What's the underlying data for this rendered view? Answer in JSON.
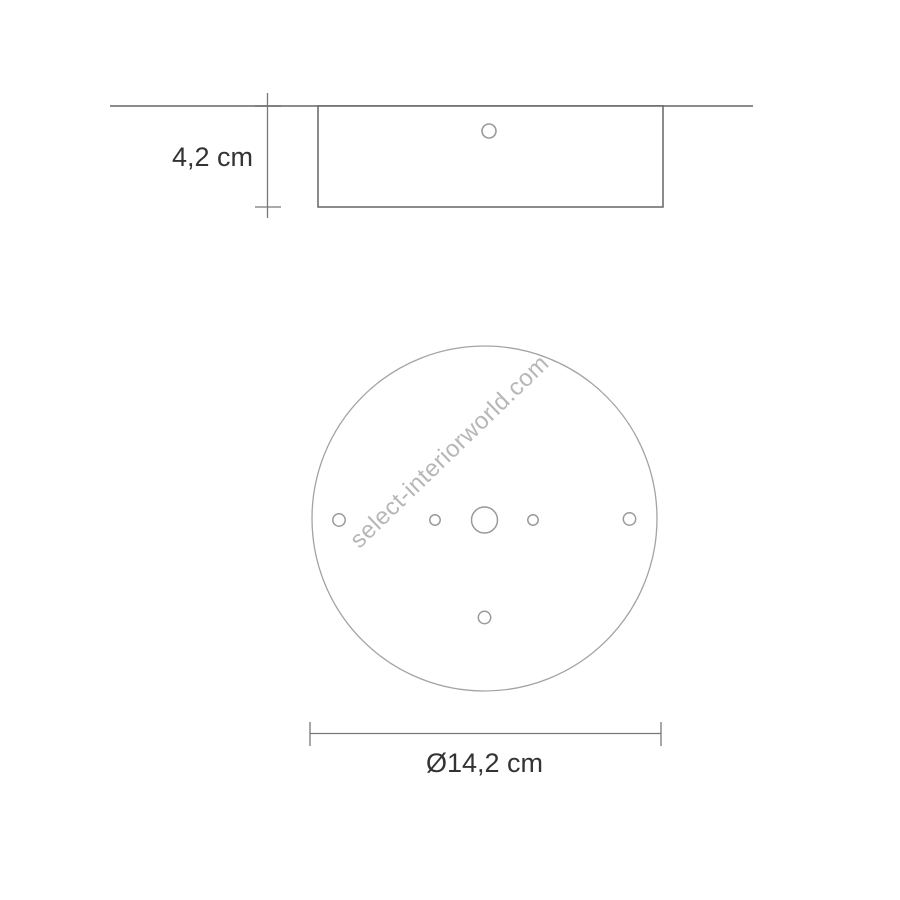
{
  "page": {
    "background": "#ffffff"
  },
  "watermark": {
    "text": "select-interiorworld.com",
    "color": "#b7b7b7"
  },
  "drawing": {
    "type": "technical-dimension-diagram",
    "subject": "round-ceiling-canopy",
    "side_view": {
      "height_dimension_label": "4,2 cm",
      "hole_count": 1
    },
    "top_view": {
      "diameter_dimension_label": "Ø14,2 cm",
      "center_hole_count": 1,
      "small_hole_count": 5
    },
    "colors": {
      "ceiling_line": "#8c8c8c",
      "outline": "#6e6e6e",
      "hole_stroke": "#9a9a9a",
      "circle_stroke": "#a3a3a3",
      "dimension_line": "#787878",
      "label_text": "#333333"
    }
  }
}
